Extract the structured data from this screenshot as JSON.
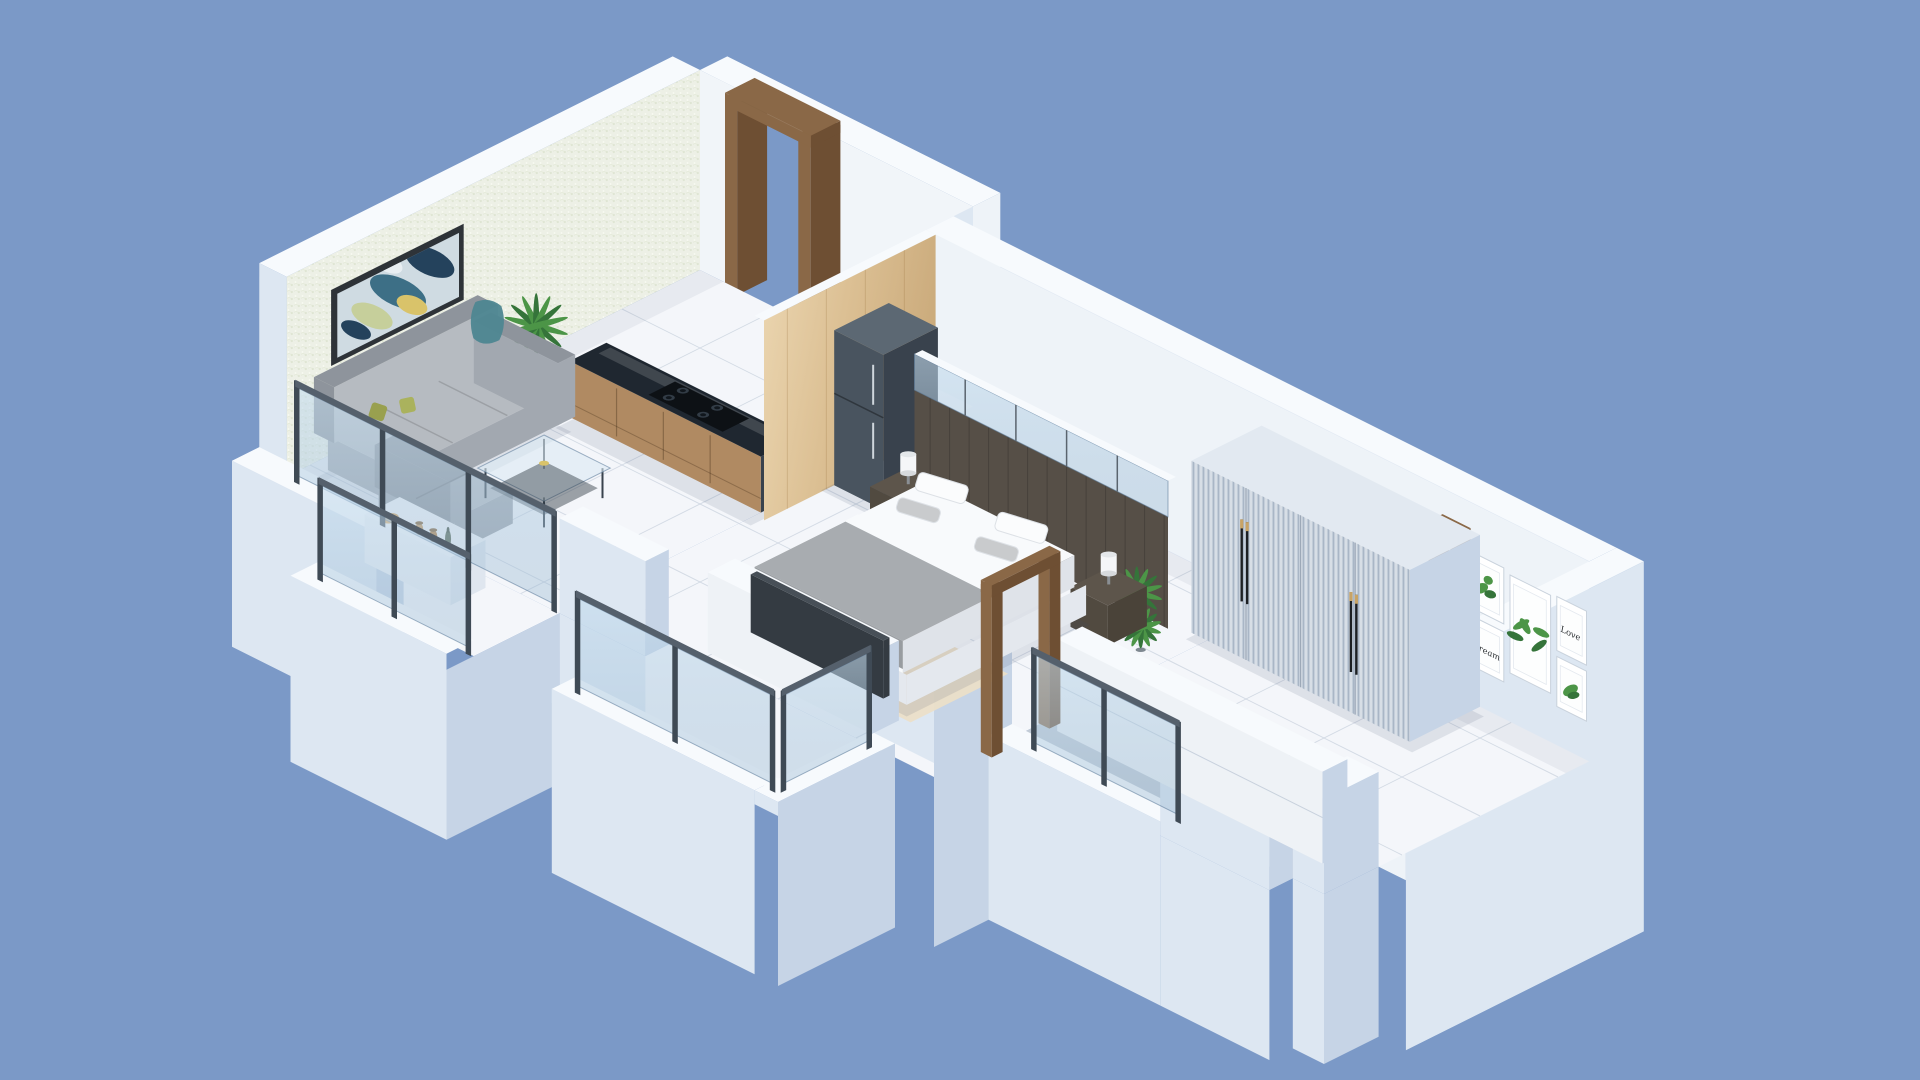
{
  "palette": {
    "bg": "#7b99c7",
    "wall-top": "#f7fafd",
    "wall-inner": "#f1f5f9",
    "wall-inner-2": "#eef3f8",
    "wall-ext": "#dde7f2",
    "wall-ext-shade": "#c6d4e6",
    "wall-ext-deep": "#b3c4da",
    "wallpaper-base": "#edf0e6",
    "floor": "#f4f6fa",
    "floor-grout": "#cfd7e2",
    "floor-grey": "#c2cbd6",
    "wood": "#8a6847",
    "wood-dark": "#6e4f33",
    "wood-panel-a": "#e8d2ad",
    "wood-panel-b": "#d3b487",
    "counter-top": "#1f2730",
    "cabinet": "#b08a62",
    "cabinet-dark": "#96714c",
    "fridge-front": "#49545f",
    "fridge-side": "#39424d",
    "fridge-top": "#5c6873",
    "sofa-seat": "#b6bbc1",
    "sofa-back": "#8e949c",
    "sofa-side": "#a2a8b0",
    "pillow-olive": "#99a04f",
    "pillow-olive2": "#aab25d",
    "throw-teal": "#4e8691",
    "bed-white": "#f8fafc",
    "bed-duvet": "#a8acb0",
    "bed-base": "#e4e8ee",
    "headboard": "#564f47",
    "nightstand": "#5d554b",
    "lamp-white": "#f5f6f8",
    "wardrobe-front": "#c4ceda",
    "wardrobe-top": "#e2e9f1",
    "handle-black": "#1c1f23",
    "handle-gold": "#c8a365",
    "glass": "rgba(168,196,220,0.42)",
    "glass-stroke": "rgba(96,126,156,0.6)",
    "post": "#3f4a55",
    "rug": "#ecdfc8",
    "rug-spot": "#d2ab74",
    "plant-green": "#4c9547",
    "plant-dark": "#35743a",
    "pot-grey": "#9aa4ad",
    "marble-wall": "#eef2f6",
    "tv-dark": "#343b42",
    "art-frame": "#2e3338",
    "art-bg": "#cfdbe2",
    "shadow": "rgba(55,75,105,0.12)"
  },
  "gallery": {
    "love_text": "Love",
    "dream_text": "Dream"
  }
}
